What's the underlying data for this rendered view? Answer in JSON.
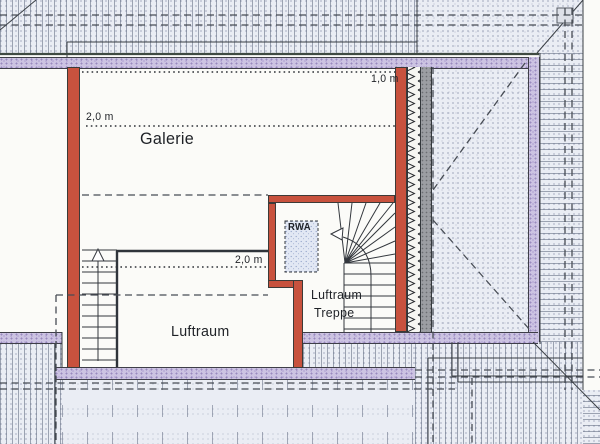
{
  "rooms": {
    "galerie": "Galerie",
    "luftraum": "Luftraum",
    "stair_line1": "Luftraum",
    "stair_line2": "Treppe"
  },
  "annotations": {
    "headroom_galerie": "2,0 m",
    "headroom_right": "1,0 m",
    "headroom_luftraum": "2,0 m",
    "smoke_vent": "RWA"
  },
  "colors": {
    "wall_red": "#c8523e",
    "wall_purple": "#ccc3e2",
    "band_gray": "#9c9ea3",
    "line_dark": "#3a3f45",
    "hatch_bg": "#eaedf4"
  }
}
